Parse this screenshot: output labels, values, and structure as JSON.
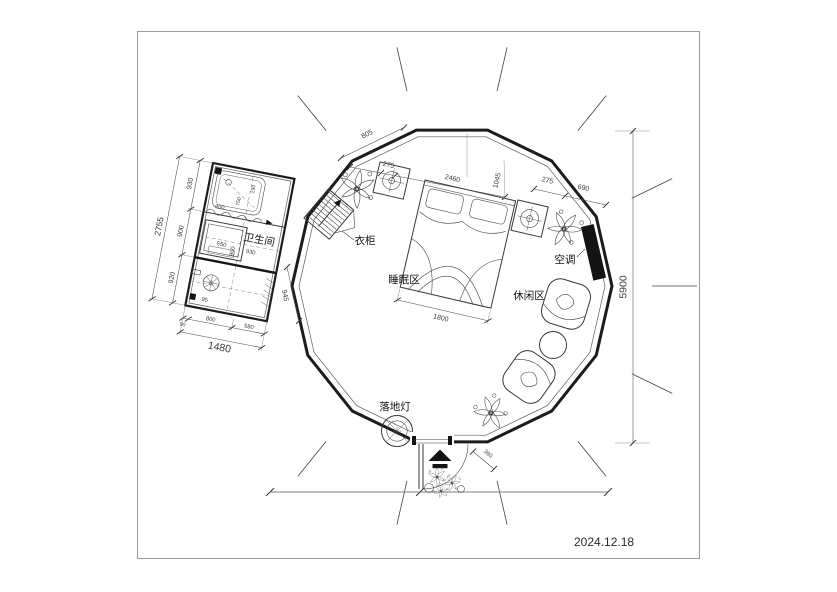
{
  "colors": {
    "ink": "#1c1c1c",
    "furniture": "#383838",
    "dimension": "#3d3d3d"
  },
  "title_block": {
    "date": "2024.12.18"
  },
  "rooms": {
    "bathroom": "卫生间",
    "sleeping_area": "睡眠区",
    "leisure_area": "休闲区"
  },
  "fixtures": {
    "wardrobe": "衣柜",
    "air_conditioner": "空调",
    "floor_lamp": "落地灯"
  },
  "dimensions": {
    "bathroom_total_depth": "2755",
    "bathroom_seg_1": "930",
    "bathroom_seg_2": "900",
    "bathroom_seg_3": "920",
    "bathroom_total_width": "1480",
    "bathroom_width_seg_small": "90",
    "bathroom_width_seg_1": "800",
    "bathroom_width_seg_2": "580",
    "bathroom_inner_width": "930",
    "bathroom_inner_depth": "900",
    "sink_width": "550",
    "tub_width": "400",
    "tub_depth": "750",
    "tub_offset": "190",
    "corner_offset": "95",
    "bathroom_door": "945",
    "wall_segment": "805",
    "nightstand_left": "275",
    "bed_head_span": "2460",
    "bed_side": "1045",
    "nightstand_right": "275",
    "ac_span": "690",
    "bed_width": "1800",
    "door_offset": "360",
    "tent_diameter": "5900"
  }
}
